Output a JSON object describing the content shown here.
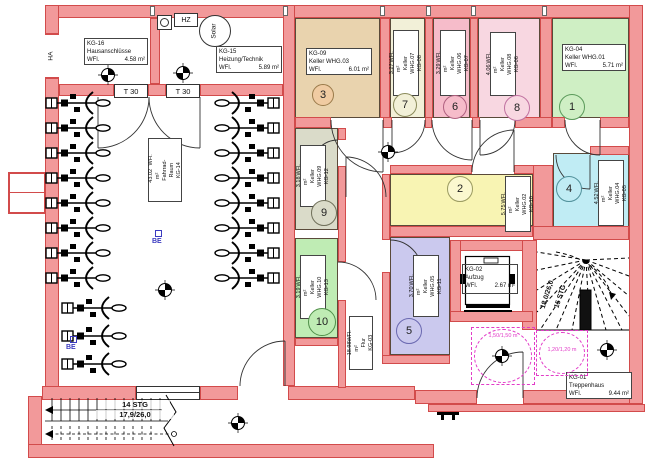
{
  "plan": {
    "rooms": {
      "kg16": {
        "code": "KG-16",
        "name": "Hausanschlüsse",
        "wfl": "WFl.",
        "area": "4.58 m²"
      },
      "kg15": {
        "code": "KG-15",
        "name": "Heizung/Technik",
        "wfl": "WFl.",
        "area": "5.89 m²"
      },
      "kg09": {
        "code": "KG-09",
        "name": "Keller WHG.03",
        "wfl": "WFl.",
        "area": "6.01 m²",
        "num": "3"
      },
      "kg08": {
        "code": "KG-08",
        "name": "Keller WHG.07",
        "wfl": "WFl.",
        "area": "3.27 m²",
        "num": "7"
      },
      "kg07": {
        "code": "KG-07",
        "name": "Keller WHG.06",
        "wfl": "WFl.",
        "area": "3.29 m²",
        "num": "6"
      },
      "kg06": {
        "code": "KG-06",
        "name": "Keller WHG.08",
        "wfl": "WFl.",
        "area": "4.06 m²",
        "num": "8"
      },
      "kg04": {
        "code": "KG-04",
        "name": "Keller WHG.01",
        "wfl": "WFl.",
        "area": "5.71 m²",
        "num": "1"
      },
      "kg12": {
        "code": "KG-12",
        "name": "Keller WHG.09",
        "wfl": "WFl.",
        "area": "3.18 m²",
        "num": "9"
      },
      "kg10": {
        "code": "KG-10",
        "name": "Keller WHG.02",
        "wfl": "WFl.",
        "area": "5.75 m²",
        "num": "2"
      },
      "kg05": {
        "code": "KG-05",
        "name": "Keller WHG.04",
        "wfl": "WFl.",
        "area": "4.52 m²",
        "num": "4"
      },
      "kg13": {
        "code": "KG-13",
        "name": "Keller WHG.10",
        "wfl": "WFl.",
        "area": "3.19 m²",
        "num": "10"
      },
      "kg11": {
        "code": "KG-11",
        "name": "Keller WHG.05",
        "wfl": "WFl.",
        "area": "3.70 m²",
        "num": "5"
      },
      "kg03": {
        "code": "KG-03",
        "name": "Flur",
        "wfl": "WFl.",
        "area": "18.98 m²"
      },
      "kg14": {
        "code": "KG-14",
        "name": "Fahrrad-Raum",
        "wfl": "WFl.",
        "area": "43.02 m²"
      },
      "kg02": {
        "code": "KG-02",
        "name": "Aufzug",
        "wfl": "WFl.",
        "area": "2.67 m²"
      },
      "kg01": {
        "code": "KG-01",
        "name": "Treppenhaus",
        "wfl": "WFl.",
        "area": "9.44 m²"
      }
    },
    "annotations": {
      "ha": "HA",
      "hz": "HZ",
      "solar": "Solar",
      "t30": "T 30",
      "be": "BE",
      "stairs_right_steps": "15 STG",
      "stairs_right_dim": "18,0/26,0",
      "stairs_left_steps": "14 STG",
      "stairs_left_dim": "17,9/26,0",
      "clearance_large": "1,50/1,50 m",
      "clearance_small": "1,20/1,20 m"
    },
    "colors": {
      "wall_fill": "#f2999a",
      "wall_edge": "#d24b4b",
      "kg09": "#e9d3ae",
      "kg08": "#f2f0d8",
      "kg07": "#f6bcca",
      "kg06": "#f8d7e1",
      "kg04": "#cfefc4",
      "kg12": "#dadbc9",
      "kg10": "#f8f4b3",
      "kg05": "#c0ecf4",
      "kg13": "#bfecb4",
      "kg11": "#cbc9ee",
      "clearance": "#e23cc8",
      "be_marker": "#3b3bc0"
    }
  }
}
